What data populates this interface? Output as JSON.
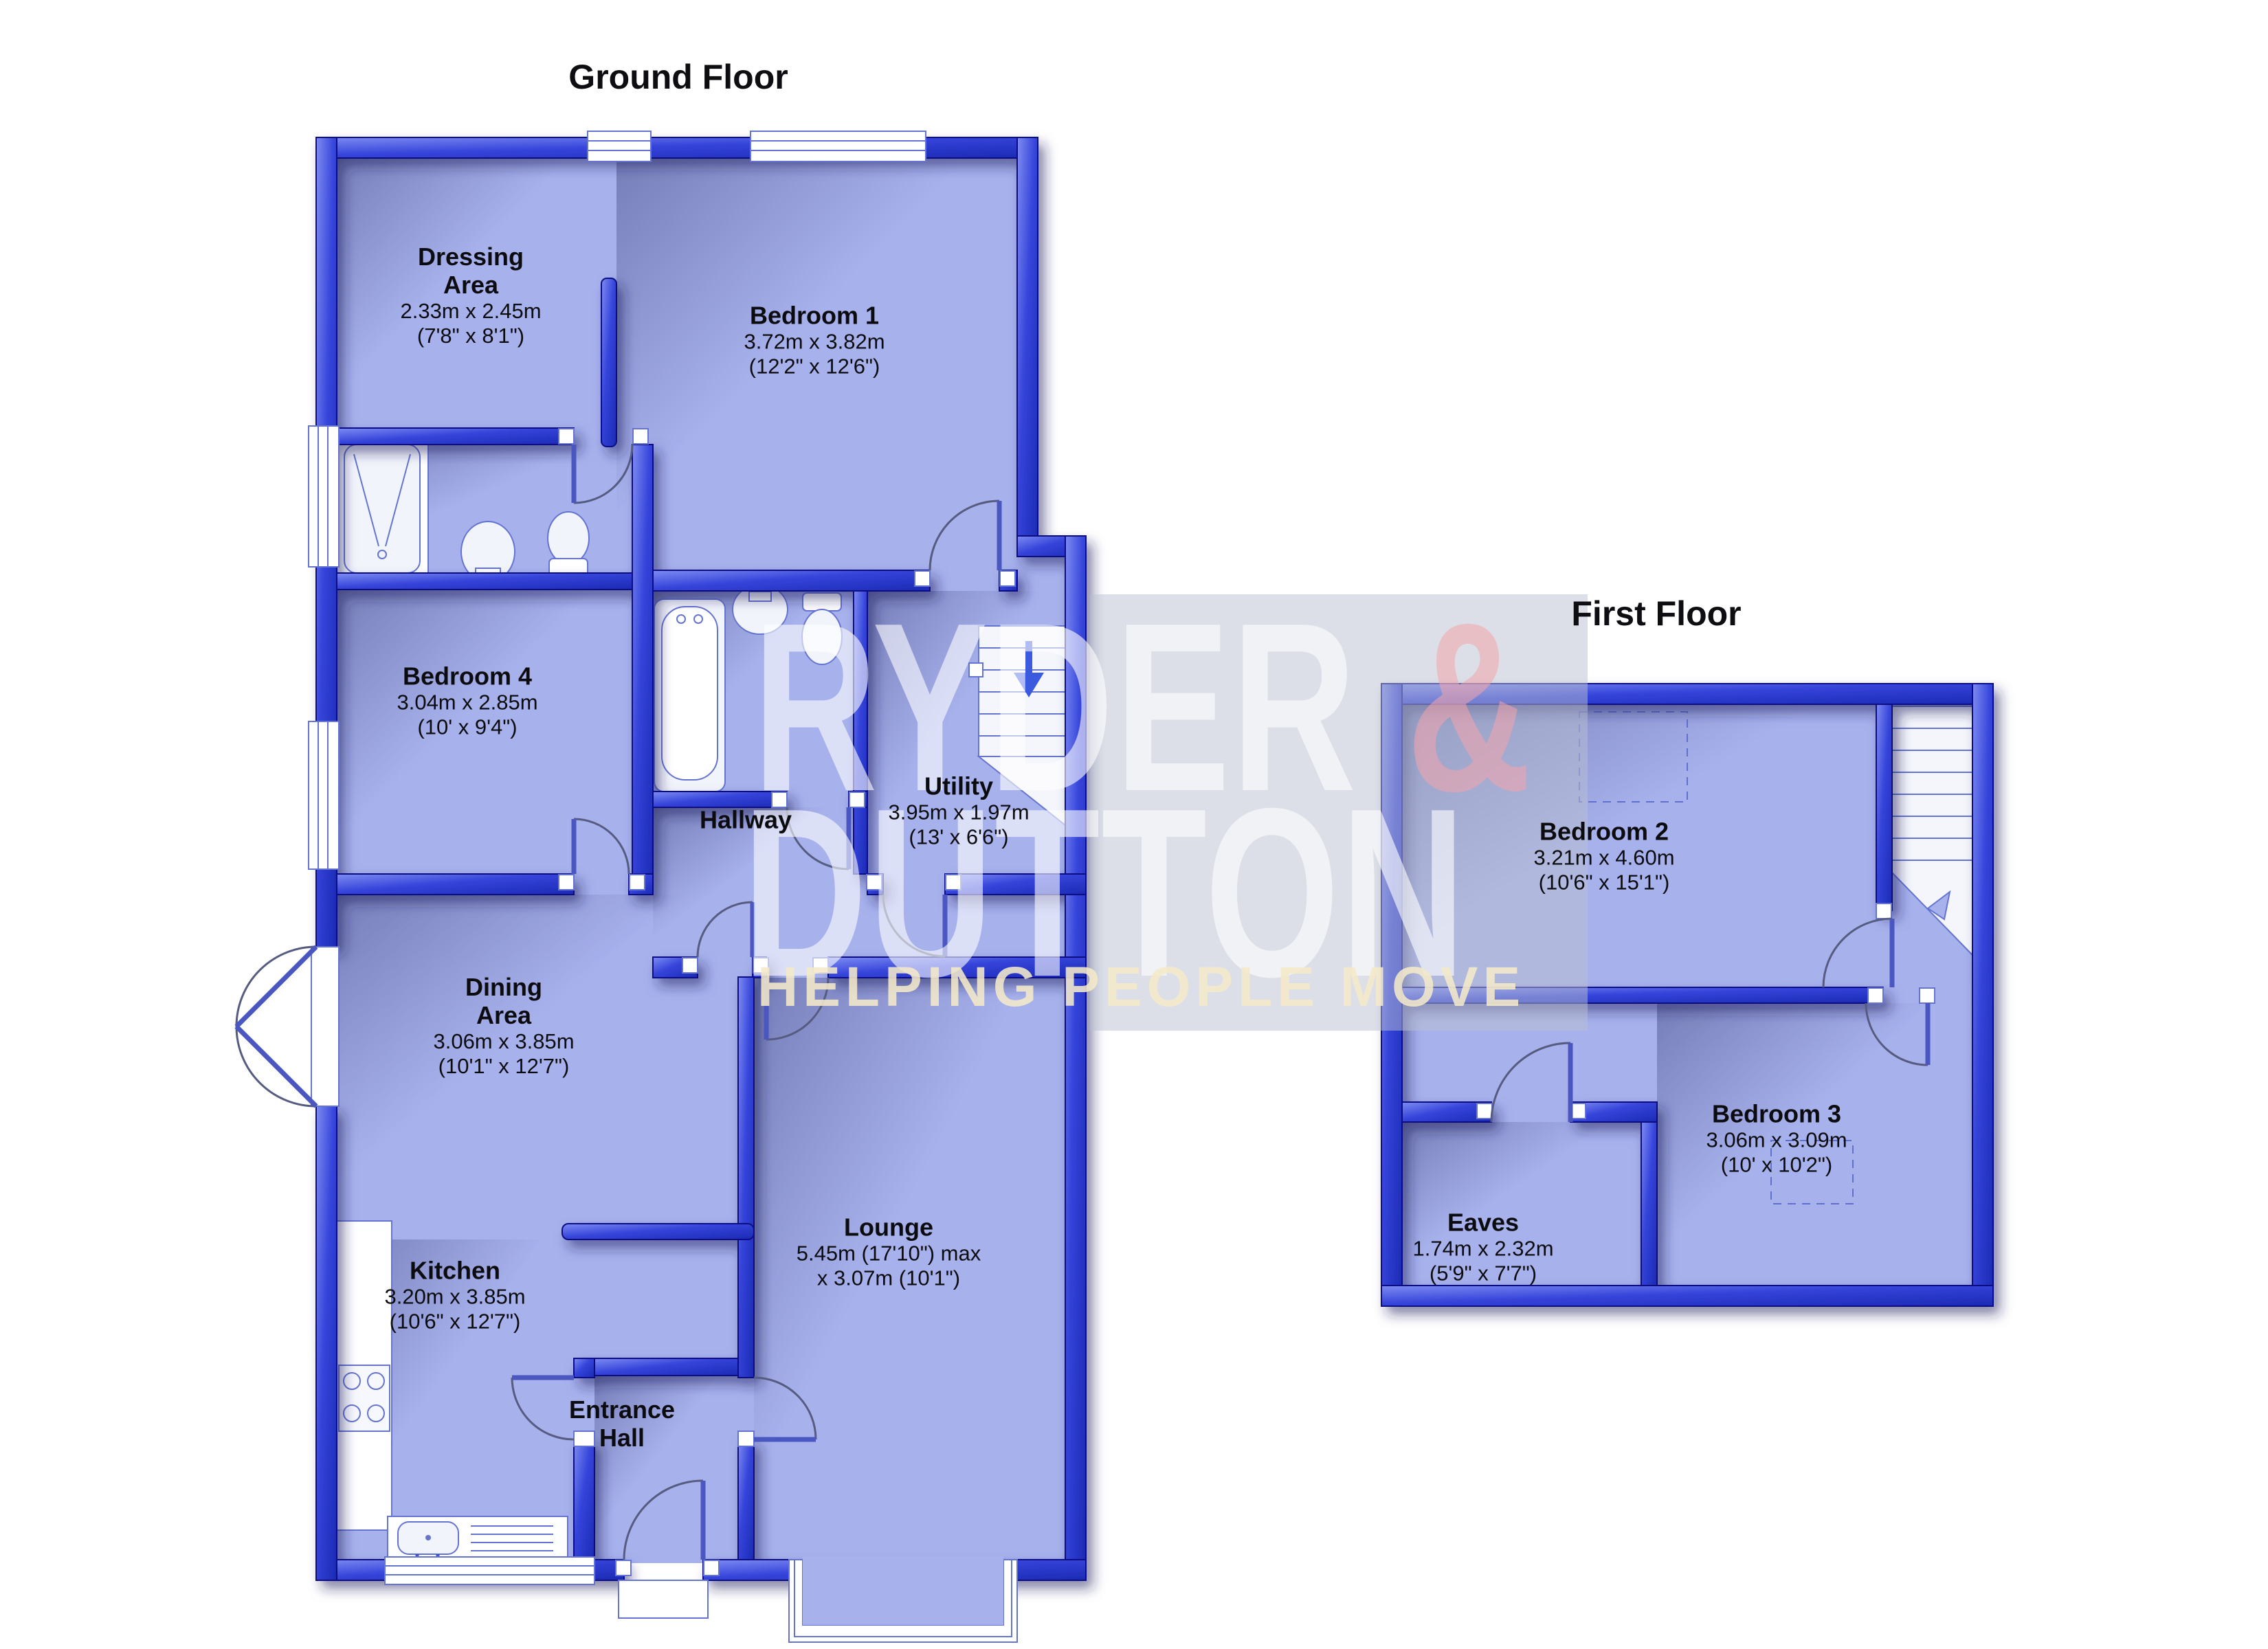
{
  "ground_floor": {
    "title": "Ground Floor",
    "rooms": {
      "dressing": {
        "lines": [
          "Dressing",
          "Area",
          "2.33m x 2.45m",
          "(7'8\" x 8'1\")"
        ]
      },
      "bedroom1": {
        "lines": [
          "Bedroom 1",
          "3.72m x 3.82m",
          "(12'2\" x 12'6\")"
        ]
      },
      "bedroom4": {
        "lines": [
          "Bedroom 4",
          "3.04m x 2.85m",
          "(10' x 9'4\")"
        ]
      },
      "hallway": {
        "lines": [
          "Hallway"
        ]
      },
      "utility": {
        "lines": [
          "Utility",
          "3.95m x 1.97m",
          "(13' x 6'6\")"
        ]
      },
      "dining": {
        "lines": [
          "Dining",
          "Area",
          "3.06m x 3.85m",
          "(10'1\" x 12'7\")"
        ]
      },
      "kitchen": {
        "lines": [
          "Kitchen",
          "3.20m x 3.85m",
          "(10'6\" x 12'7\")"
        ]
      },
      "entrance": {
        "lines": [
          "Entrance",
          "Hall"
        ]
      },
      "lounge": {
        "lines": [
          "Lounge",
          "5.45m (17'10\") max",
          "x 3.07m (10'1\")"
        ]
      }
    }
  },
  "first_floor": {
    "title": "First Floor",
    "rooms": {
      "bedroom2": {
        "lines": [
          "Bedroom 2",
          "3.21m x 4.60m",
          "(10'6\" x 15'1\")"
        ]
      },
      "bedroom3": {
        "lines": [
          "Bedroom 3",
          "3.06m x 3.09m",
          "(10' x 10'2\")"
        ]
      },
      "eaves": {
        "lines": [
          "Eaves",
          "1.74m x 2.32m",
          "(5'9\" x 7'7\")"
        ]
      }
    }
  },
  "watermark": {
    "brand_word1": "RYDER",
    "brand_amp": "&",
    "brand_word2": "DUTTON",
    "tagline": "HELPING PEOPLE MOVE"
  },
  "colors": {
    "wall_blue": "#2f3fd4",
    "wall_outline": "#0b1183",
    "floor_periwinkle": "#a7b1ec",
    "fixture_stroke": "#6474d0",
    "stair_arrow_blue": "#3c5ae0",
    "watermark_band": "#bac0d0",
    "watermark_amp_pink": "#f4a4ac",
    "watermark_tagline_cream": "#f4e9ca",
    "label_text": "#0c0c10"
  }
}
